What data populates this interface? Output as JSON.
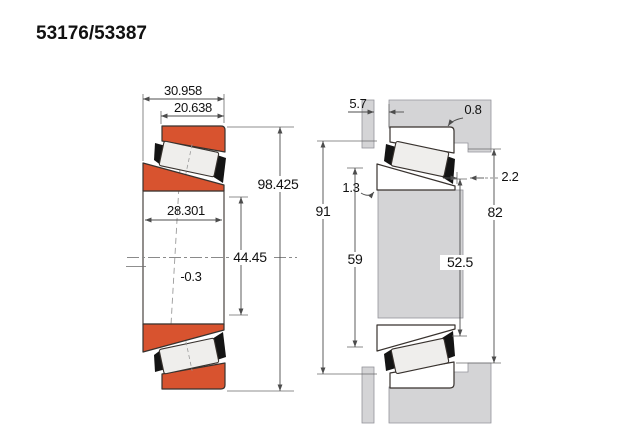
{
  "title": "53176/53387",
  "colors": {
    "bearing_orange": "#d8532f",
    "housing_gray": "#d4d4d6",
    "outline": "#38322e",
    "background": "#ffffff"
  },
  "left_view": {
    "dims": {
      "overall_width": "30.958",
      "cup_width": "20.638",
      "outer_diameter": "98.425",
      "inner_width": "28.301",
      "bore_diameter": "44.45",
      "offset": "-0.3"
    }
  },
  "right_view": {
    "dims": {
      "top_gap": "5.7",
      "fillet_radius": "0.8",
      "backface_clearance": "1.3",
      "front_clearance": "2.2",
      "housing_abutment_dia": "91",
      "shaft_abutment_dia_left": "59",
      "housing_shoulder_dia": "82",
      "shaft_abutment_dia_right": "52.5"
    }
  }
}
